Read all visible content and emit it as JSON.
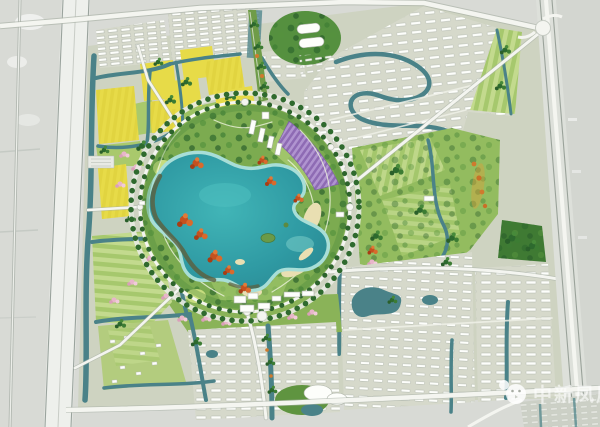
{
  "watermark": {
    "text": "中新凤凰",
    "mascot_icon": "chick-mascot-icon"
  },
  "palette": {
    "background": "#d8dad5",
    "outside_gray": "#d3d6d0",
    "road_white": "#f4f5f0",
    "pad": "#d6d9cb",
    "canal": "#4a8288",
    "lake_deep": "#2f9aa3",
    "lake_mid": "#41b5b7",
    "lake_shallow": "#a8ded7",
    "sand": "#e9dfb2",
    "park_green": "#7cab50",
    "east_park_green": "#93bc5f",
    "tree_dark": "#2d672c",
    "tree_red": "#c4511f",
    "field_yellow": "#e7db48",
    "farmland_light": "#c3da8e",
    "farmland_dark": "#a6c86d",
    "lavender": "#b094d0",
    "lavender_dark": "#8e6bb4",
    "blossom_pink": "#e8b6ca",
    "house_white": "#fdfefb",
    "watermark_white": "#ffffff"
  },
  "regions": [
    {
      "name": "central-lake-park"
    },
    {
      "name": "ring-boulevard"
    },
    {
      "name": "lavender-field"
    },
    {
      "name": "yellow-rapeseed-fields"
    },
    {
      "name": "northwest-residential"
    },
    {
      "name": "north-residential"
    },
    {
      "name": "northeast-residential"
    },
    {
      "name": "east-park"
    },
    {
      "name": "southeast-residential"
    },
    {
      "name": "south-residential"
    },
    {
      "name": "southwest-farmland"
    },
    {
      "name": "west-expressway"
    },
    {
      "name": "east-expressway"
    },
    {
      "name": "north-boundary-road"
    },
    {
      "name": "south-boundary-road"
    },
    {
      "name": "interchange"
    },
    {
      "name": "watermark"
    }
  ]
}
